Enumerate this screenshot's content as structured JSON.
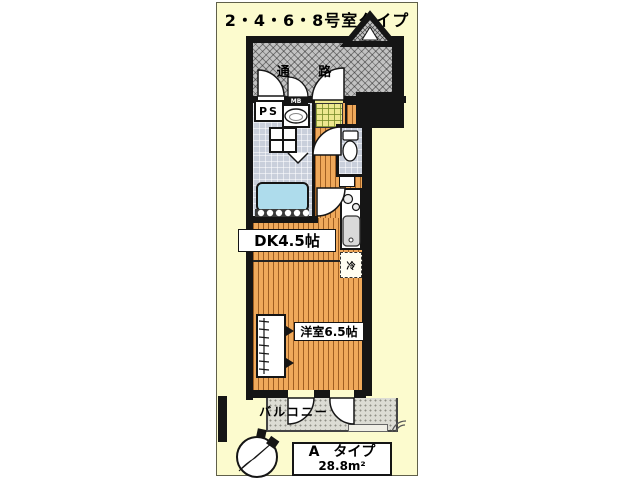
{
  "title": "2・4・6・8号室タイプ",
  "rooms": {
    "corridor": "通 路",
    "pipe_space": "PS",
    "meter_box": "MB",
    "dining_kitchen": "DK4.5帖",
    "western_room": "洋室6.5帖",
    "balcony": "バルコニー",
    "refrigerator": "冷"
  },
  "legend": {
    "type_name": "A　タイプ",
    "floor_area": "28.8m²"
  },
  "colors": {
    "panel_bg": "#fcfbce",
    "wall": "#151515",
    "wood_floor": "#efa95b",
    "wet_area_floor": "#c9cfdb",
    "entrance_tile": "#ede88f",
    "corridor_hatch": "#c2c2c2",
    "balcony_floor": "#dcdcd4",
    "bathtub": "#aedcec"
  }
}
